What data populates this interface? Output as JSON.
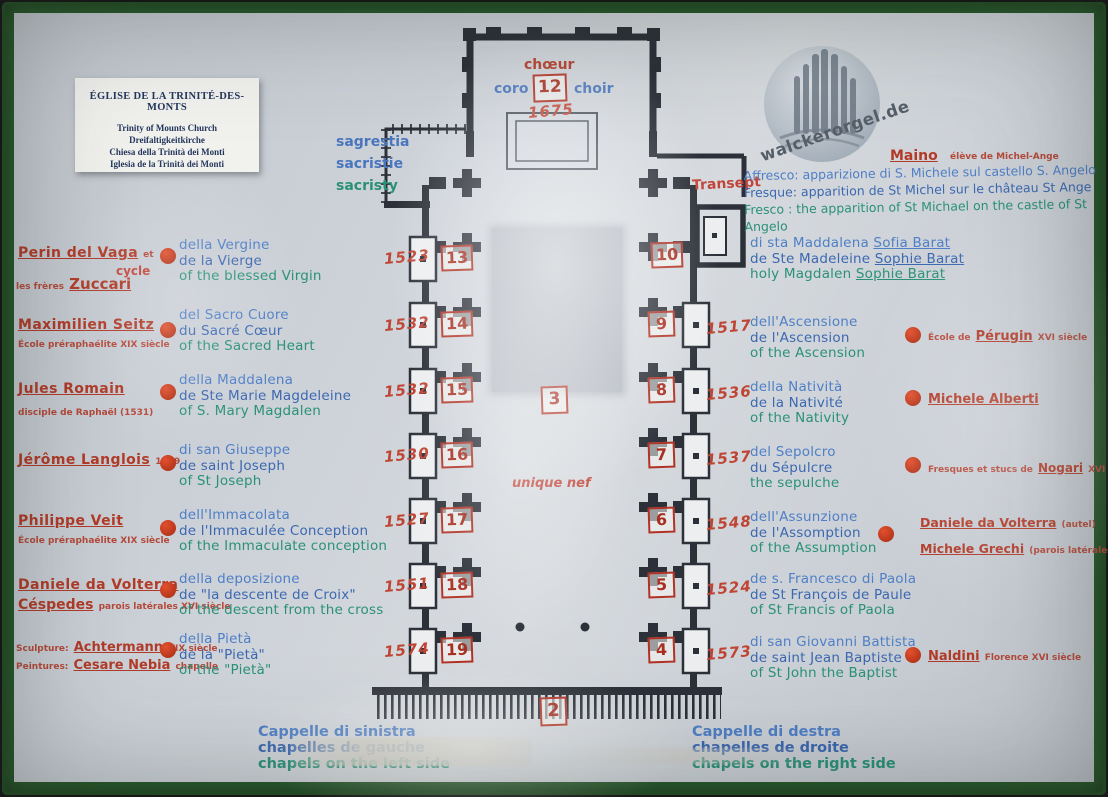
{
  "title_card": {
    "title": "ÉGLISE DE LA TRINITÉ-DES-MONTS",
    "lines": [
      "Trinity of Mounts Church",
      "Dreifaltigkeitkirche",
      "Chiesa della Trinità dei Monti",
      "Iglesia de la Trinità dei Monti"
    ]
  },
  "logo": {
    "text": "walckerorgel.de"
  },
  "choir": {
    "fr": "chœur",
    "it": "coro",
    "number": "12",
    "en": "choir",
    "year": "1675"
  },
  "sacristy": {
    "l1": "sagrestia",
    "l2": "sacristie",
    "l3": "sacristy"
  },
  "transept": "Transept",
  "fresco": {
    "artist": "Maino",
    "artist_note": "élève de Michel-Ange",
    "l1": "Affresco: apparizione di S. Michele sul castello S. Angelo",
    "l2": "Fresque: apparition de St Michel sur le château St Ange",
    "l3": "Fresco : the apparition of St Michael on the castle of St Angelo"
  },
  "nave": {
    "number": "3",
    "label": "unique nef"
  },
  "entrance": {
    "number": "2"
  },
  "left": [
    {
      "year": "1523",
      "number": "13",
      "a1": "Perin del Vaga",
      "a1post": "et",
      "mid": "cycle",
      "a2pre": "les frères",
      "a2": "Zuccari",
      "d1": "della Vergine",
      "d2": "de la Vierge",
      "d3": "of the blessed Virgin"
    },
    {
      "year": "1532",
      "number": "14",
      "a1": "Maximilien Seitz",
      "note": "École préraphaélite XIX siècle",
      "d1": "del Sacro Cuore",
      "d2": "du Sacré Cœur",
      "d3": "of the Sacred Heart"
    },
    {
      "year": "1532",
      "number": "15",
      "a1": "Jules Romain",
      "note": "disciple de Raphaël (1531)",
      "d1": "della Maddalena",
      "d2": "de Ste Marie Magdeleine",
      "d3": "of S. Mary Magdalen"
    },
    {
      "year": "1530",
      "number": "16",
      "a1": "Jérôme Langlois",
      "a1post": "1809",
      "d1": "di san Giuseppe",
      "d2": "de saint Joseph",
      "d3": "of St Joseph"
    },
    {
      "year": "1527",
      "number": "17",
      "a1": "Philippe Veit",
      "note": "École préraphaélite XIX siècle",
      "d1": "dell'Immacolata",
      "d2": "de l'Immaculée Conception",
      "d3": "of the Immaculate conception"
    },
    {
      "year": "1551",
      "number": "18",
      "a1": "Daniele da Volterra",
      "a2": "Céspedes",
      "a2post": "parois latérales XVI siècle",
      "d1": "della deposizione",
      "d2": "de \"la descente de Croix\"",
      "d3": "of the descent from the cross"
    },
    {
      "year": "1574",
      "number": "19",
      "a1pre": "Sculpture:",
      "a1": "Achtermann",
      "a1post": "XIX siècle",
      "a2pre": "Peintures:",
      "a2": "Cesare Nebia",
      "a2post": "chapelle",
      "d1": "della Pietà",
      "d2": "de la \"Pietà\"",
      "d3": "of the \"Pietà\""
    }
  ],
  "right": [
    {
      "number": "10",
      "d1a": "di sta Maddalena",
      "d1b": "Sofia Barat",
      "d2a": "de Ste Madeleine",
      "d2b": "Sophie Barat",
      "d3a": "holy Magdalen",
      "d3b": "Sophie Barat"
    },
    {
      "year": "1517",
      "number": "9",
      "d1": "dell'Ascensione",
      "d2": "de l'Ascension",
      "d3": "of the Ascension",
      "apre": "École de",
      "a": "Pérugin",
      "apost": "XVI siècle"
    },
    {
      "year": "1536",
      "number": "8",
      "d1": "della Natività",
      "d2": "de la Nativité",
      "d3": "of the Nativity",
      "a": "Michele Alberti"
    },
    {
      "year": "1537",
      "number": "7",
      "d1": "del Sepolcro",
      "d2": "du Sépulcre",
      "d3": "the sepulche",
      "apre": "Fresques et stucs de",
      "a": "Nogari",
      "apost": "XVI siècle"
    },
    {
      "year": "1548",
      "number": "6",
      "d1": "dell'Assunzione",
      "d2": "de l'Assomption",
      "d3": "of the Assumption",
      "a": "Daniele da Volterra",
      "apost": "(autel)",
      "a2": "Michele Grechi",
      "a2post": "(parois latérales)"
    },
    {
      "year": "1524",
      "number": "5",
      "d1": "de s. Francesco di Paola",
      "d2": "de St François de Paule",
      "d3": "of St Francis of Paola"
    },
    {
      "year": "1573",
      "number": "4",
      "d1": "di san Giovanni Battista",
      "d2": "de saint Jean Baptiste",
      "d3": "of St John the Baptist",
      "a": "Naldini",
      "apost": "Florence XVI siècle"
    }
  ],
  "bottom_left": {
    "l1": "Cappelle di sinistra",
    "l2": "chapelles de gauche",
    "l3": "chapels on the left side"
  },
  "bottom_right": {
    "l1": "Cappelle di destra",
    "l2": "chapelles de droite",
    "l3": "chapels on the right side"
  },
  "colors": {
    "red": "#b23b28",
    "blue": "#3c68b0",
    "green": "#2a9178",
    "frame": "#2b5e2d",
    "ink": "#2c3038"
  }
}
